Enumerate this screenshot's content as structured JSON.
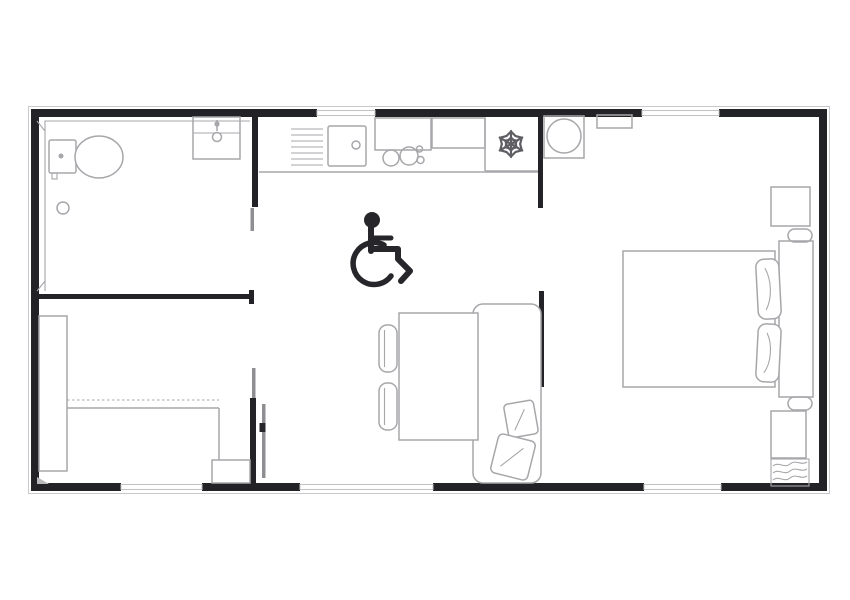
{
  "colors": {
    "background": "#ffffff",
    "floor": "#ffffff",
    "wall": "#232327",
    "furniture": "#a7a7ab",
    "furniture_dark": "#8f8f93",
    "window": "#c3c3c6",
    "snowflake": "#5f5f63",
    "icon": "#26262b"
  },
  "icons": {
    "wheelchair": "wheelchair-accessibility-symbol",
    "snowflake": "refrigerator-snowflake-symbol",
    "faucet": "washbasin-faucet-symbol"
  }
}
